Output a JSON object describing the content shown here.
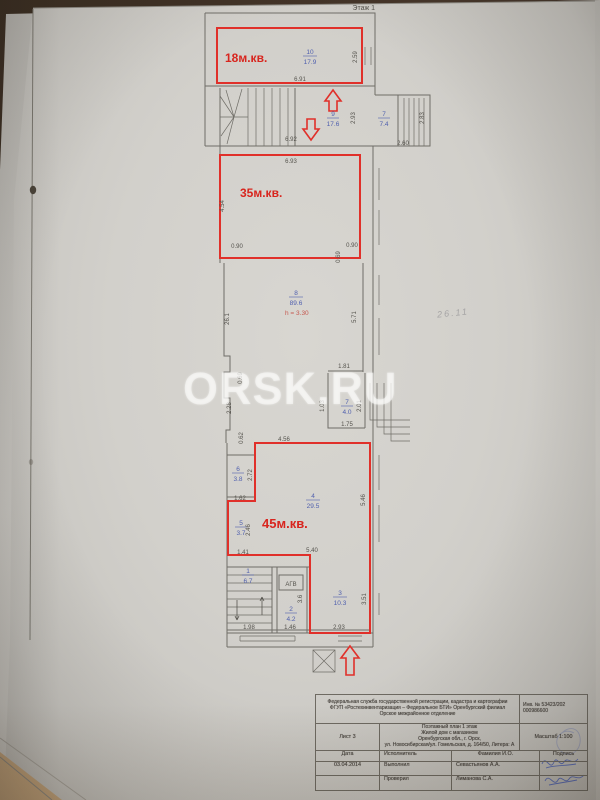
{
  "photo": {
    "watermark": "ORSK.RU",
    "pencil_note": "26.11"
  },
  "plan": {
    "floor_label": "Этаж 1",
    "red": {
      "room18": "18м.кв.",
      "room35": "35м.кв.",
      "room45": "45м.кв.",
      "ceiling_height": "h = 3.30"
    },
    "agv_label": "АГВ",
    "rooms": {
      "r10_num": "10",
      "r10_area": "17.9",
      "r9_num": "9",
      "r9_area": "17.6",
      "r7w_num": "7",
      "r7w_area": "7.4",
      "r8_num": "8",
      "r8_area": "89.6",
      "r7_num": "7",
      "r7_area": "4.0",
      "r6_num": "6",
      "r6_area": "3.8",
      "r5_num": "5",
      "r5_area": "3.7",
      "r4_num": "4",
      "r4_area": "29.5",
      "r3_num": "3",
      "r3_area": "10.3",
      "r2_num": "2",
      "r2_area": "4.2",
      "r1_num": "1",
      "r1_area": "6.7"
    },
    "dims": {
      "d6_91": "6.91",
      "d2_59": "2.59",
      "d6_92": "6.92",
      "d2_93": "2.93",
      "d2_83": "2.83",
      "d2_60": "2.60",
      "d6_93": "6.93",
      "d4_54": "4.54",
      "d0_90": "0.90",
      "d0_69": "0.69",
      "d26_1": "26.1",
      "d5_71": "5.71",
      "d1_81": "1.81",
      "d2_28": "2.28",
      "d0_62": "0.62",
      "d1_03": "1.03",
      "d2_01": "2.01",
      "d1_75": "1.75",
      "d4_56": "4.56",
      "d2_72": "2.72",
      "d1_62": "1.62",
      "d5_46": "5.46",
      "d2_46": "2.46",
      "d1_41": "1.41",
      "d5_40": "5.40",
      "d1_98": "1.98",
      "d1_46": "1.46",
      "d3_6": "3.6",
      "d3_51": "3.51"
    }
  },
  "stamp": {
    "header_line1": "Федеральная служба государственной регистрации, кадастра и картографии",
    "header_line2": "ФГУП «Ростехинвентаризация – Федеральное БТИ» Оренбургский филиал",
    "header_line3": "Орское межрайонное отделение",
    "inv_line1": "Инв. № 53423/202",
    "inv_line2": "000986600",
    "sheet": "Лист 3",
    "title_line1": "Поэтажный план 1 этаж",
    "title_line2": "Жилой дом с магазином",
    "title_line3": "Оренбургская обл., г. Орск,",
    "title_line4": "ул. Новосибирская/ул. Гомельская, д. 164/50, Литера: А",
    "scale": "Масштаб 1:100",
    "col_date": "Дата",
    "col_executor": "Исполнитель",
    "col_name": "Фамилия И.О.",
    "col_sign": "Подпись",
    "date": "03.04.2014",
    "row1_role": "Выполнил",
    "row1_name": "Севастьянов А.А.",
    "row2_role": "Проверил",
    "row2_name": "Лиманова С.А."
  }
}
